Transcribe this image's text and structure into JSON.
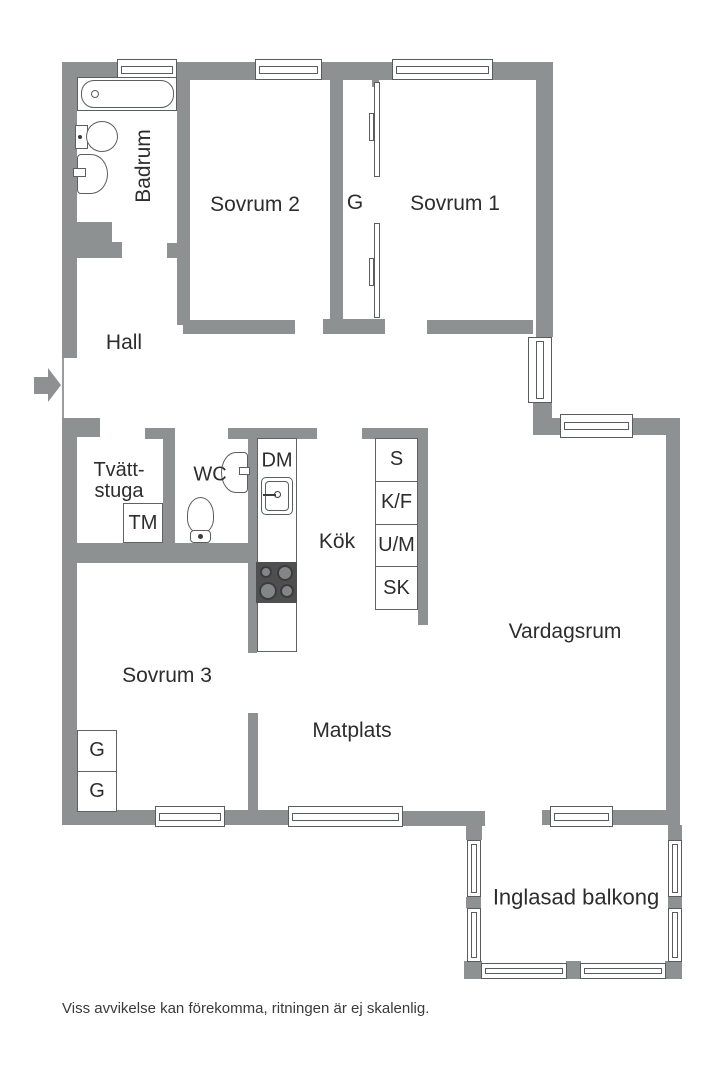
{
  "colors": {
    "wall": "#8d9192",
    "outline": "#5a5e5f",
    "text": "#2d2d2d",
    "stove-bg": "#4f4f4f",
    "burner": "#838687"
  },
  "rooms": {
    "badrum": "Badrum",
    "sovrum2": "Sovrum 2",
    "garderob_top": "G",
    "sovrum1": "Sovrum 1",
    "hall": "Hall",
    "tvattstuga_line1": "Tvätt-",
    "tvattstuga_line2": "stuga",
    "wc": "WC",
    "kok": "Kök",
    "vardagsrum": "Vardagsrum",
    "sovrum3": "Sovrum 3",
    "matplats": "Matplats",
    "balkong": "Inglasad balkong"
  },
  "appliances": {
    "dm": "DM",
    "tm": "TM"
  },
  "cabinets": [
    "S",
    "K/F",
    "U/M",
    "SK"
  ],
  "closet_cells": [
    "G",
    "G"
  ],
  "footer": {
    "disclaimer": "Viss avvikelse kan förekomma, ritningen är ej skalenlig."
  }
}
